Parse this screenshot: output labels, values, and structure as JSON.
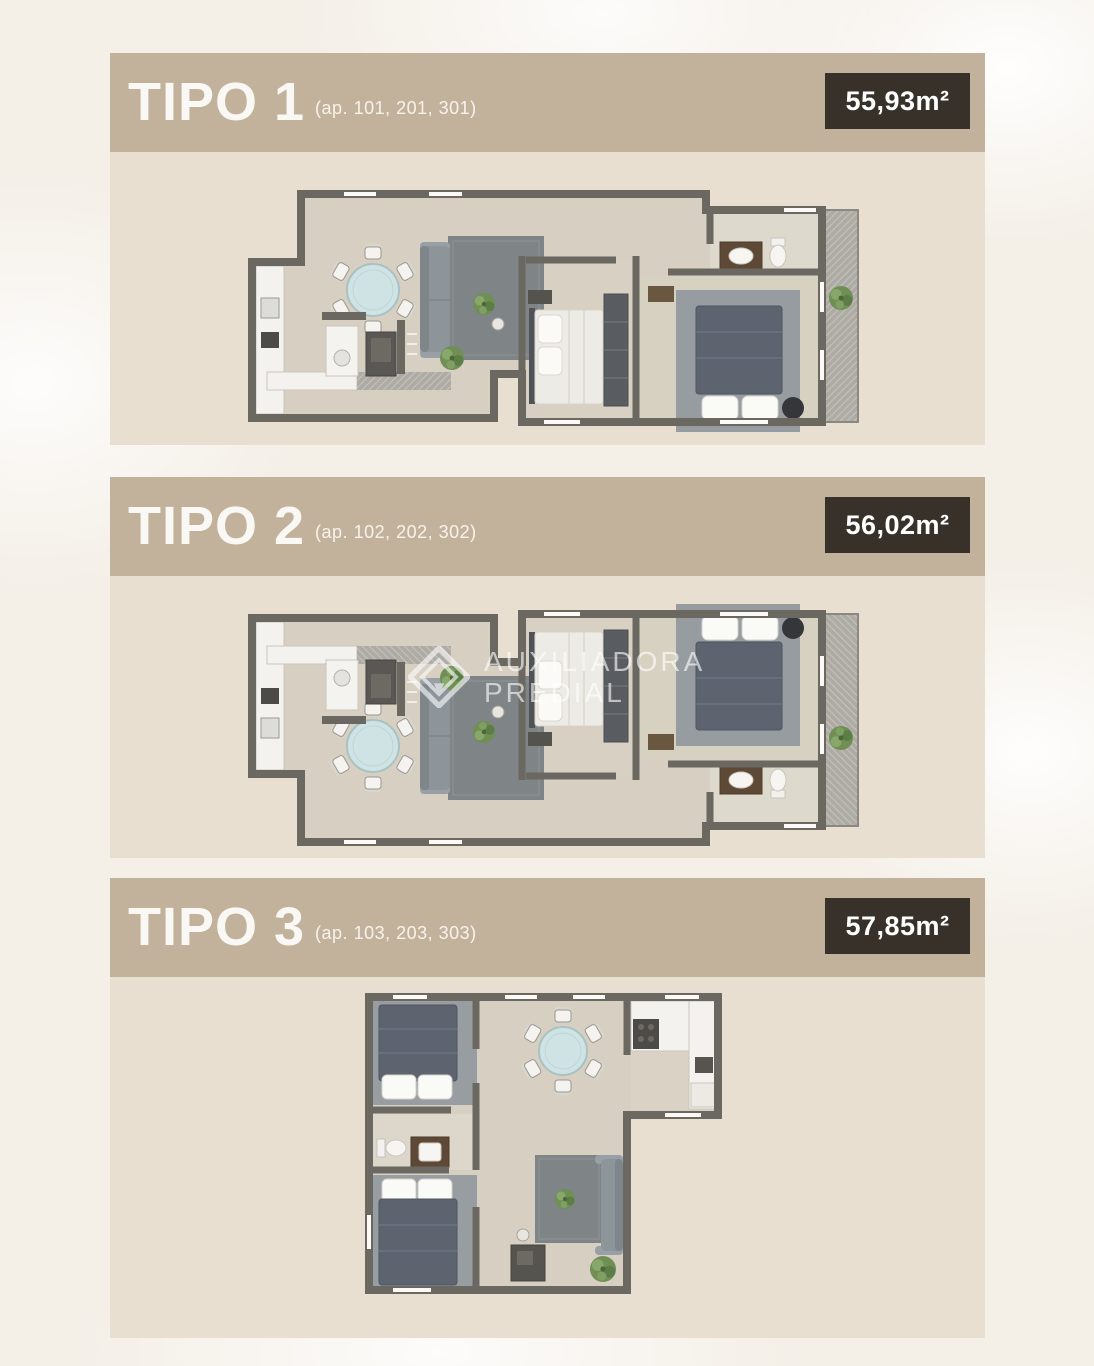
{
  "page": {
    "width": 1094,
    "height": 1366,
    "background": "#f4efe7"
  },
  "colors": {
    "panel_header": "#c3b29b",
    "panel_body": "#e9dfd0",
    "badge_bg": "#38312a",
    "badge_text": "#ffffff",
    "title_text": "#faf8f4",
    "wall": "#6b6862",
    "floor": "#d6cfc2",
    "table_top": "#cfe3e5",
    "plant": "#6f8f55"
  },
  "watermark": {
    "line1": "AUXILIADORA",
    "line2": "PREDIAL"
  },
  "panels": [
    {
      "title": "TIPO 1",
      "units": "(ap. 101, 201, 301)",
      "area": "55,93m²"
    },
    {
      "title": "TIPO 2",
      "units": "(ap. 102, 202, 302)",
      "area": "56,02m²"
    },
    {
      "title": "TIPO 3",
      "units": "(ap. 103, 203, 303)",
      "area": "57,85m²"
    }
  ]
}
